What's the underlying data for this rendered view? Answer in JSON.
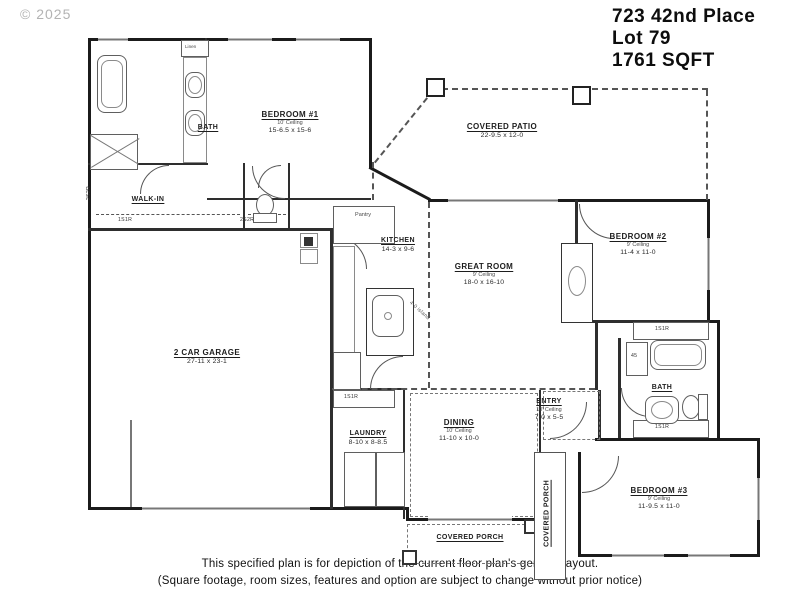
{
  "copyright": "© 2025",
  "title": {
    "address": "723 42nd Place",
    "lot": "Lot 79",
    "sqft": "1761 SQFT"
  },
  "disclaimer": {
    "line1": "This specified plan is for depiction of the current floor plan's general layout.",
    "line2": "(Square footage, room sizes, features and option are subject to change without prior notice)"
  },
  "rooms": {
    "bedroom1": {
      "name": "BEDROOM #1",
      "ceiling": "10' Ceiling",
      "dims": "15-6.5 x 15-6"
    },
    "bath1": {
      "name": "BATH"
    },
    "walkin": {
      "name": "WALK-IN"
    },
    "garage": {
      "name": "2 CAR GARAGE",
      "dims": "27-11 x 23-1"
    },
    "kitchen": {
      "name": "KITCHEN",
      "dims": "14-3 x 9-6"
    },
    "pantry": {
      "name": "Pantry"
    },
    "great": {
      "name": "GREAT ROOM",
      "ceiling": "9' Ceiling",
      "dims": "18-0 x 16-10"
    },
    "bedroom2": {
      "name": "BEDROOM #2",
      "ceiling": "9' Ceiling",
      "dims": "11-4 x 11-0"
    },
    "bath2": {
      "name": "BATH"
    },
    "laundry": {
      "name": "LAUNDRY",
      "dims": "8-10 x 8-8.5"
    },
    "dining": {
      "name": "DINING",
      "ceiling": "10' Ceiling",
      "dims": "11-10 x 10-0"
    },
    "entry": {
      "name": "ENTRY",
      "ceiling": "10' Ceiling",
      "dims": "7-0 x 5-5"
    },
    "bedroom3": {
      "name": "BEDROOM #3",
      "ceiling": "9' Ceiling",
      "dims": "11-9.5 x 11-0"
    },
    "patio": {
      "name": "COVERED PATIO",
      "dims": "22-9.5 x 12-0"
    },
    "porch": {
      "name": "COVERED PORCH"
    },
    "porch_side": {
      "name": "COVERED PORCH"
    }
  },
  "tags": {
    "s1r": "1S1R",
    "s2r": "2S2R",
    "linen": "Linen",
    "cab45": "45",
    "island": "4-0 island"
  }
}
